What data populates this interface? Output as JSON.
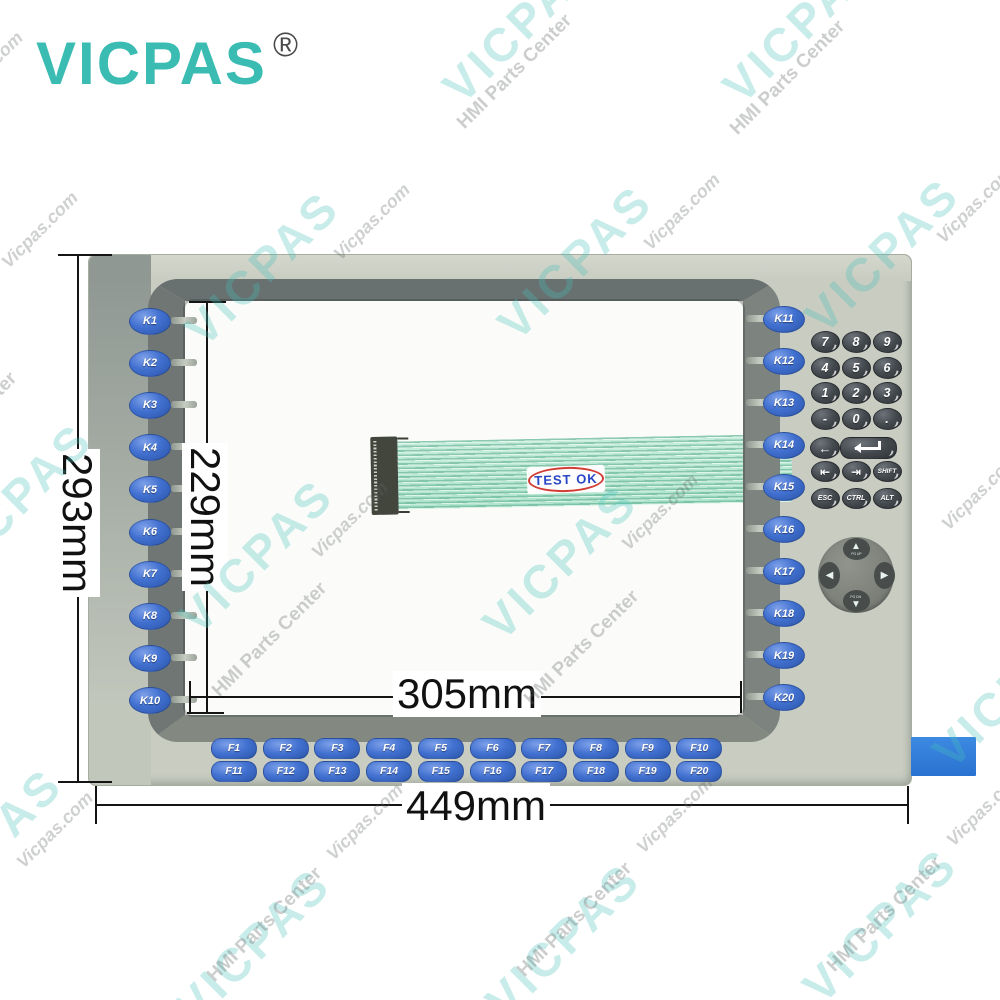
{
  "logo": {
    "text": "VICPAS",
    "registered": "®"
  },
  "dimensions": {
    "overall_height": "293mm",
    "screen_height": "229mm",
    "screen_width": "305mm",
    "overall_width": "449mm"
  },
  "panel": {
    "left_keys": [
      "K1",
      "K2",
      "K3",
      "K4",
      "K5",
      "K6",
      "K7",
      "K8",
      "K9",
      "K10"
    ],
    "right_keys": [
      "K11",
      "K12",
      "K13",
      "K14",
      "K15",
      "K16",
      "K17",
      "K18",
      "K19",
      "K20"
    ],
    "function_keys_row1": [
      "F1",
      "F2",
      "F3",
      "F4",
      "F5",
      "F6",
      "F7",
      "F8",
      "F9",
      "F10"
    ],
    "function_keys_row2": [
      "F11",
      "F12",
      "F13",
      "F14",
      "F15",
      "F16",
      "F17",
      "F18",
      "F19",
      "F20"
    ],
    "numpad": {
      "digit_rows": [
        [
          "7",
          "8",
          "9"
        ],
        [
          "4",
          "5",
          "6"
        ],
        [
          "1",
          "2",
          "3"
        ],
        [
          "-",
          "0",
          "."
        ]
      ],
      "backspace_label": "←",
      "nav_row": [
        "⇤",
        "⇥",
        "SHIFT"
      ],
      "modifier_row": [
        "ESC",
        "CTRL",
        "ALT"
      ]
    },
    "dpad": {
      "up_glyph": "▲",
      "down_glyph": "▼",
      "left_glyph": "◀",
      "right_glyph": "▶",
      "up_label": "PG UP",
      "down_label": "PG DN"
    },
    "cable_stamp": "TEST OK"
  },
  "watermarks": [
    {
      "t": "VICPAS",
      "k": "brand",
      "x": 520,
      "y": 25
    },
    {
      "t": "VICPAS",
      "k": "brand",
      "x": 800,
      "y": 25
    },
    {
      "t": "VICPAS",
      "k": "brand",
      "x": 262,
      "y": 268
    },
    {
      "t": "VICPAS",
      "k": "brand",
      "x": 575,
      "y": 262
    },
    {
      "t": "VICPAS",
      "k": "brand",
      "x": 882,
      "y": 255
    },
    {
      "t": "VICPAS",
      "k": "brand",
      "x": 15,
      "y": 500
    },
    {
      "t": "VICPAS",
      "k": "brand",
      "x": 256,
      "y": 556
    },
    {
      "t": "VICPAS",
      "k": "brand",
      "x": 560,
      "y": 562
    },
    {
      "t": "VICPAS",
      "k": "brand",
      "x": 1010,
      "y": 690
    },
    {
      "t": "VICPAS",
      "k": "brand",
      "x": -15,
      "y": 845
    },
    {
      "t": "VICPAS",
      "k": "brand",
      "x": 253,
      "y": 945
    },
    {
      "t": "VICPAS",
      "k": "brand",
      "x": 563,
      "y": 940
    },
    {
      "t": "VICPAS",
      "k": "brand",
      "x": 880,
      "y": 925
    },
    {
      "t": "HMI Parts Center",
      "k": "center",
      "x": 515,
      "y": 72
    },
    {
      "t": "HMI Parts Center",
      "k": "center",
      "x": 788,
      "y": 78
    },
    {
      "t": "HMI Parts Center",
      "k": "center",
      "x": -40,
      "y": 430
    },
    {
      "t": "HMI Parts Center",
      "k": "center",
      "x": 270,
      "y": 640
    },
    {
      "t": "HMI Parts Center",
      "k": "center",
      "x": 582,
      "y": 648
    },
    {
      "t": "HMI Parts Center",
      "k": "center",
      "x": 265,
      "y": 925
    },
    {
      "t": "HMI Parts Center",
      "k": "center",
      "x": 575,
      "y": 920
    },
    {
      "t": "HMI Parts Center",
      "k": "center",
      "x": 885,
      "y": 915
    },
    {
      "t": "Vicpas.com",
      "k": "site",
      "x": -15,
      "y": 70
    },
    {
      "t": "Vicpas.com",
      "k": "site",
      "x": 40,
      "y": 230
    },
    {
      "t": "Vicpas.com",
      "k": "site",
      "x": 372,
      "y": 222
    },
    {
      "t": "Vicpas.com",
      "k": "site",
      "x": 682,
      "y": 212
    },
    {
      "t": "Vicpas.com",
      "k": "site",
      "x": 975,
      "y": 205
    },
    {
      "t": "Vicpas.com",
      "k": "site",
      "x": 350,
      "y": 520
    },
    {
      "t": "Vicpas.com",
      "k": "site",
      "x": 660,
      "y": 512
    },
    {
      "t": "Vicpas.com",
      "k": "site",
      "x": 980,
      "y": 492
    },
    {
      "t": "Vicpas.com",
      "k": "site",
      "x": 55,
      "y": 830
    },
    {
      "t": "Vicpas.com",
      "k": "site",
      "x": 365,
      "y": 822
    },
    {
      "t": "Vicpas.com",
      "k": "site",
      "x": 675,
      "y": 815
    },
    {
      "t": "Vicpas.com",
      "k": "site",
      "x": 985,
      "y": 808
    }
  ]
}
